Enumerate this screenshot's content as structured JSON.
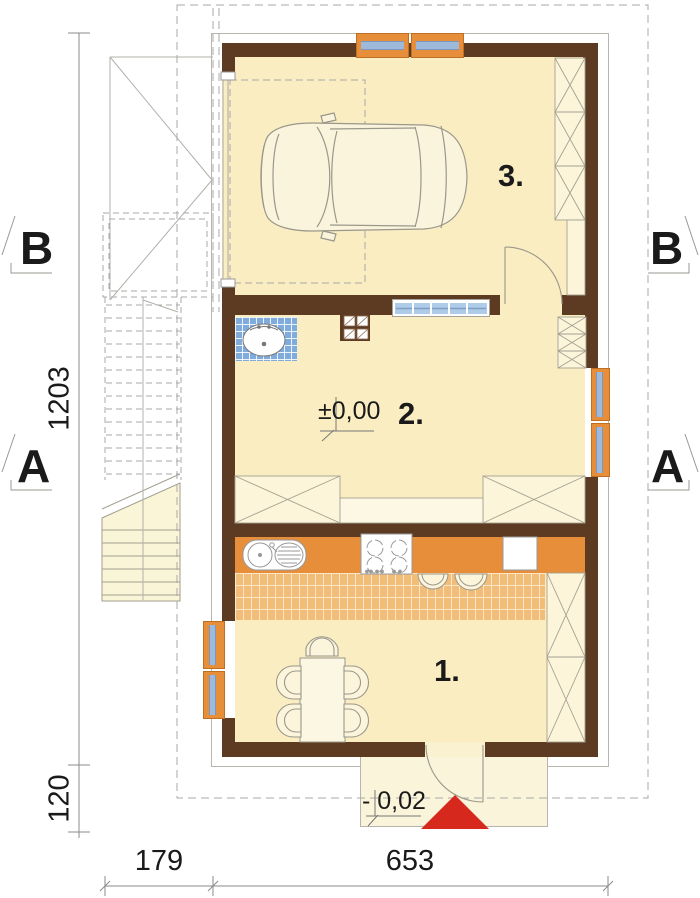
{
  "plan": {
    "section_markers": {
      "top_left": "B",
      "top_right": "B",
      "mid_left": "A",
      "mid_right": "A"
    },
    "room_labels": {
      "garage": "3.",
      "hall": "2.",
      "kitchen": "1."
    },
    "level_markers": {
      "ground_floor": "±0,00",
      "entrance": "- 0,02"
    },
    "dimensions": {
      "left_total": "1203",
      "left_porch": "120",
      "bottom_left": "179",
      "bottom_main": "653"
    },
    "colors": {
      "wall": "#5D3B22",
      "floor": "#FAEDC2",
      "furniture": "#FCF5DA",
      "window_frame_orange": "#E78E3B",
      "glass_blue": "#9FB9DB",
      "bath_tile_blue": "#7FACDD",
      "kitchen_tile_orange": "#F2BC79",
      "entrance_arrow_red": "#D7281D"
    }
  }
}
